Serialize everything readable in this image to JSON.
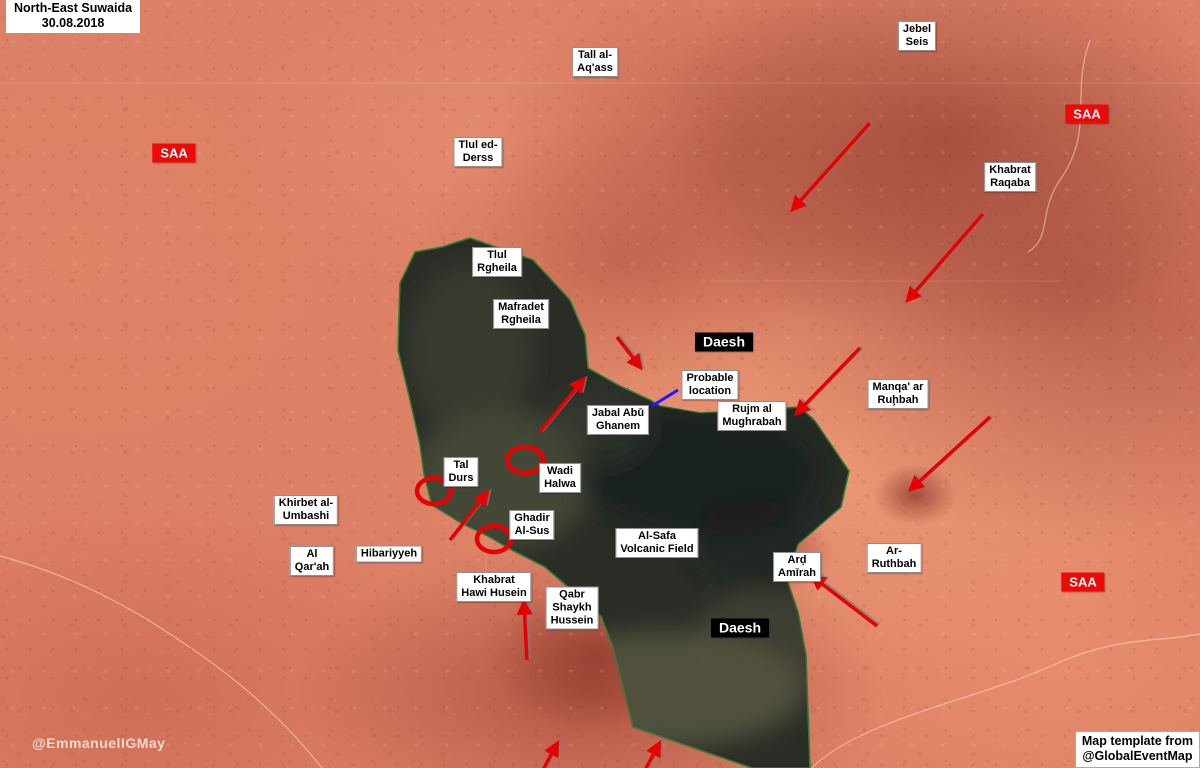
{
  "title": {
    "line1": "North-East Suwaida",
    "line2": "30.08.2018"
  },
  "credits": {
    "watermark": "@EmmanuelIGMay",
    "template_line1": "Map template from",
    "template_line2": "@GlobalEventMap"
  },
  "colors": {
    "saa_box": "#ee0808",
    "daesh_box": "#000000",
    "arrow": "#e60000",
    "circle": "#e60000",
    "frontline": "#2e7d32",
    "probable_link": "#1a1aff",
    "territory_fill": "#2a2d26"
  },
  "faction_labels": [
    {
      "name": "saa-west",
      "text": "SAA",
      "type": "saa",
      "x": 174,
      "y": 153
    },
    {
      "name": "saa-northeast",
      "text": "SAA",
      "type": "saa",
      "x": 1087,
      "y": 114
    },
    {
      "name": "saa-southeast",
      "text": "SAA",
      "type": "saa",
      "x": 1083,
      "y": 582
    },
    {
      "name": "daesh-north",
      "text": "Daesh",
      "type": "daesh",
      "x": 724,
      "y": 342
    },
    {
      "name": "daesh-south",
      "text": "Daesh",
      "type": "daesh",
      "x": 740,
      "y": 628
    }
  ],
  "place_labels": [
    {
      "name": "tall-al-aqass",
      "lines": [
        "Tall al-",
        "Aq'ass"
      ],
      "x": 595,
      "y": 62
    },
    {
      "name": "jebel-seis",
      "lines": [
        "Jebel",
        "Seis"
      ],
      "x": 917,
      "y": 36
    },
    {
      "name": "tlul-ed-derss",
      "lines": [
        "Tlul ed-",
        "Derss"
      ],
      "x": 478,
      "y": 152
    },
    {
      "name": "khabrat-raqaba",
      "lines": [
        "Khabrat",
        "Raqaba"
      ],
      "x": 1010,
      "y": 177
    },
    {
      "name": "tlul-rgheila",
      "lines": [
        "Tlul",
        "Rgheila"
      ],
      "x": 497,
      "y": 262
    },
    {
      "name": "mafradet-rgheila",
      "lines": [
        "Mafradet",
        "Rgheila"
      ],
      "x": 521,
      "y": 314
    },
    {
      "name": "probable-location",
      "lines": [
        "Probable",
        "location"
      ],
      "x": 710,
      "y": 385
    },
    {
      "name": "jabal-abu-ghanem",
      "lines": [
        "Jabal Abū",
        "Ghanem"
      ],
      "x": 618,
      "y": 420
    },
    {
      "name": "rujm-al-mughrabah",
      "lines": [
        "Rujm al",
        "Mughrabah"
      ],
      "x": 752,
      "y": 416
    },
    {
      "name": "manqa-ar-ruhbah",
      "lines": [
        "Manqa' ar",
        "Ruḩbah"
      ],
      "x": 898,
      "y": 394
    },
    {
      "name": "tal-durs",
      "lines": [
        "Tal",
        "Durs"
      ],
      "x": 461,
      "y": 472
    },
    {
      "name": "wadi-halwa",
      "lines": [
        "Wadi",
        "Halwa"
      ],
      "x": 560,
      "y": 478
    },
    {
      "name": "khirbet-al-umbashi",
      "lines": [
        "Khirbet al-",
        "Umbashi"
      ],
      "x": 306,
      "y": 510
    },
    {
      "name": "ghadir-al-sus",
      "lines": [
        "Ghadir",
        "Al-Sus"
      ],
      "x": 532,
      "y": 525
    },
    {
      "name": "al-qarah",
      "lines": [
        "Al",
        "Qar'ah"
      ],
      "x": 312,
      "y": 561
    },
    {
      "name": "hibariyyeh",
      "lines": [
        "Hibariyyeh"
      ],
      "x": 389,
      "y": 554
    },
    {
      "name": "khabrat-hawi-husein",
      "lines": [
        "Khabrat",
        "Hawi Husein"
      ],
      "x": 494,
      "y": 587
    },
    {
      "name": "qabr-shaykh-hussein",
      "lines": [
        "Qabr",
        "Shaykh",
        "Hussein"
      ],
      "x": 572,
      "y": 608
    },
    {
      "name": "al-safa-volcanic-field",
      "lines": [
        "Al-Safa",
        "Volcanic Field"
      ],
      "x": 657,
      "y": 543
    },
    {
      "name": "ard-amirah",
      "lines": [
        "Arḑ",
        "Amīrah"
      ],
      "x": 797,
      "y": 567
    },
    {
      "name": "ar-ruthbah",
      "lines": [
        "Ar-",
        "Ruthbah"
      ],
      "x": 894,
      "y": 558
    }
  ],
  "territory": {
    "name": "daesh-held-area",
    "path": "M470,238 L533,260 L570,300 L585,335 L588,368 L618,385 L650,400 L660,406 L700,413 L760,410 L800,407 L815,421 L849,471 L841,507 L798,544 L786,577 L798,612 L806,655 L810,768 L752,768 L633,727 L612,645 L601,616 L545,567 L510,549 L488,536 L463,524 L432,505 L424,474 L420,445 L410,400 L398,350 L400,283 L415,252 L442,247 Z",
    "texture_blobs": [
      {
        "cx": 500,
        "cy": 480,
        "rx": 90,
        "ry": 70,
        "fill": "#565b41",
        "opacity": 0.55
      },
      {
        "cx": 470,
        "cy": 350,
        "rx": 62,
        "ry": 85,
        "fill": "#45483a",
        "opacity": 0.5
      },
      {
        "cx": 700,
        "cy": 470,
        "rx": 125,
        "ry": 65,
        "fill": "#14181a",
        "opacity": 0.65
      },
      {
        "cx": 760,
        "cy": 545,
        "rx": 70,
        "ry": 45,
        "fill": "#1a1e1e",
        "opacity": 0.5
      },
      {
        "cx": 660,
        "cy": 690,
        "rx": 145,
        "ry": 58,
        "fill": "#6e6c4e",
        "opacity": 0.55
      },
      {
        "cx": 770,
        "cy": 640,
        "rx": 80,
        "ry": 48,
        "fill": "#57553f",
        "opacity": 0.45
      },
      {
        "cx": 595,
        "cy": 430,
        "rx": 55,
        "ry": 35,
        "fill": "#3c4035",
        "opacity": 0.5
      }
    ]
  },
  "attack_arrows": [
    {
      "name": "arrow-north-center",
      "x1": 870,
      "y1": 123,
      "x2": 793,
      "y2": 209
    },
    {
      "name": "arrow-khabrat-raqaba",
      "x1": 983,
      "y1": 214,
      "x2": 908,
      "y2": 300
    },
    {
      "name": "arrow-rujm-mughrabah",
      "x1": 860,
      "y1": 348,
      "x2": 797,
      "y2": 413
    },
    {
      "name": "arrow-manqa-ruhbah",
      "x1": 990,
      "y1": 417,
      "x2": 911,
      "y2": 489
    },
    {
      "name": "arrow-daesh-north-small",
      "x1": 617,
      "y1": 337,
      "x2": 640,
      "y2": 367
    },
    {
      "name": "arrow-jabal-abu-ghanem",
      "x1": 540,
      "y1": 432,
      "x2": 583,
      "y2": 380
    },
    {
      "name": "arrow-hibariyyeh",
      "x1": 450,
      "y1": 540,
      "x2": 487,
      "y2": 493
    },
    {
      "name": "arrow-khabrat-hawi",
      "x1": 527,
      "y1": 660,
      "x2": 524,
      "y2": 603
    },
    {
      "name": "arrow-ard-amirah",
      "x1": 877,
      "y1": 626,
      "x2": 813,
      "y2": 577
    },
    {
      "name": "arrow-south-left",
      "x1": 543,
      "y1": 770,
      "x2": 557,
      "y2": 744
    },
    {
      "name": "arrow-south-right",
      "x1": 645,
      "y1": 770,
      "x2": 659,
      "y2": 744
    }
  ],
  "position_circles": [
    {
      "name": "circle-tal-durs",
      "cx": 434,
      "cy": 491,
      "rx": 17,
      "ry": 13
    },
    {
      "name": "circle-wadi-halwa",
      "cx": 525,
      "cy": 460,
      "rx": 18,
      "ry": 13
    },
    {
      "name": "circle-ghadir-al-sus",
      "cx": 494,
      "cy": 539,
      "rx": 17,
      "ry": 13
    }
  ],
  "probable_location_link": {
    "x1": 652,
    "y1": 406,
    "x2": 678,
    "y2": 390
  },
  "roads": [
    {
      "name": "road-northeast",
      "d": "M1090,40 C1070,95 1095,130 1060,180 C1038,212 1052,238 1028,252"
    },
    {
      "name": "road-southeast",
      "d": "M812,768 C862,718 980,700 1060,662 C1120,636 1162,642 1200,634"
    },
    {
      "name": "road-southwest",
      "d": "M0,556 C66,574 124,602 182,642 C258,692 300,740 322,768"
    }
  ],
  "graticule": [
    {
      "name": "grid-h-north",
      "x1": 0,
      "y1": 83,
      "x2": 1200,
      "y2": 83
    },
    {
      "name": "grid-h-center",
      "x1": 700,
      "y1": 281,
      "x2": 1060,
      "y2": 281
    },
    {
      "name": "grid-v-center",
      "x1": 486,
      "y1": 230,
      "x2": 486,
      "y2": 600
    }
  ]
}
